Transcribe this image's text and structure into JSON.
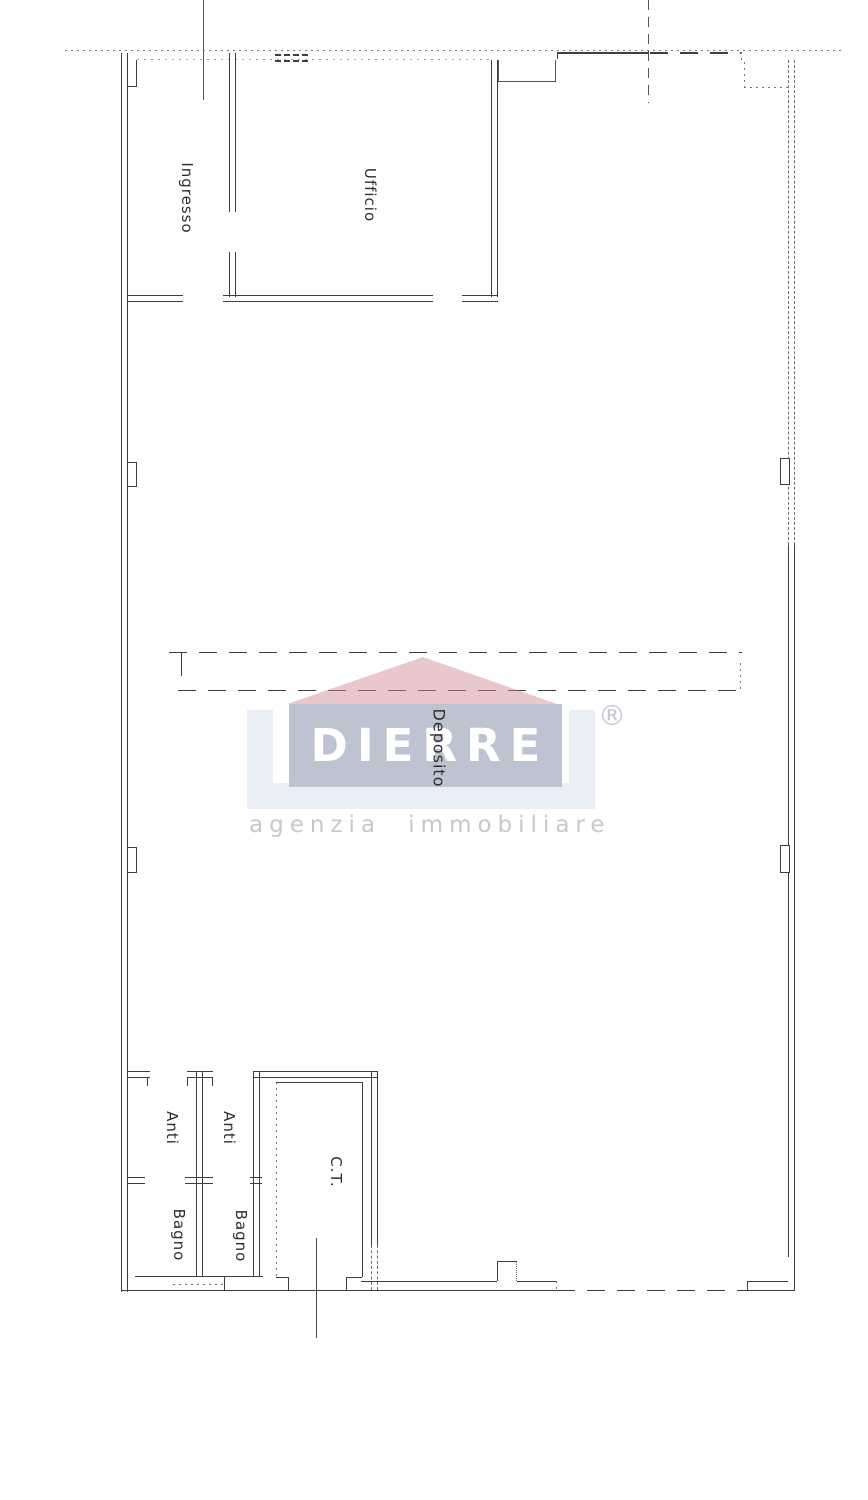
{
  "plan": {
    "rooms": [
      {
        "name": "ingresso",
        "label": "Ingresso"
      },
      {
        "name": "ufficio",
        "label": "Ufficio"
      },
      {
        "name": "deposito",
        "label": "Deposito"
      },
      {
        "name": "anti-1",
        "label": "Anti"
      },
      {
        "name": "anti-2",
        "label": "Anti"
      },
      {
        "name": "bagno-1",
        "label": "Bagno"
      },
      {
        "name": "bagno-2",
        "label": "Bagno"
      },
      {
        "name": "ct",
        "label": "C.T."
      }
    ],
    "line_color": "#3e3e3e"
  },
  "watermark": {
    "brand": "DIERRE",
    "tagline": "agenzia immobiliare",
    "registered": "®",
    "colors": {
      "roof": "#eac6ca",
      "box": "#bdc3d0",
      "frame": "#eaeef6",
      "brand_text": "#ffffff",
      "tagline_text": "#c8c8c8"
    }
  }
}
